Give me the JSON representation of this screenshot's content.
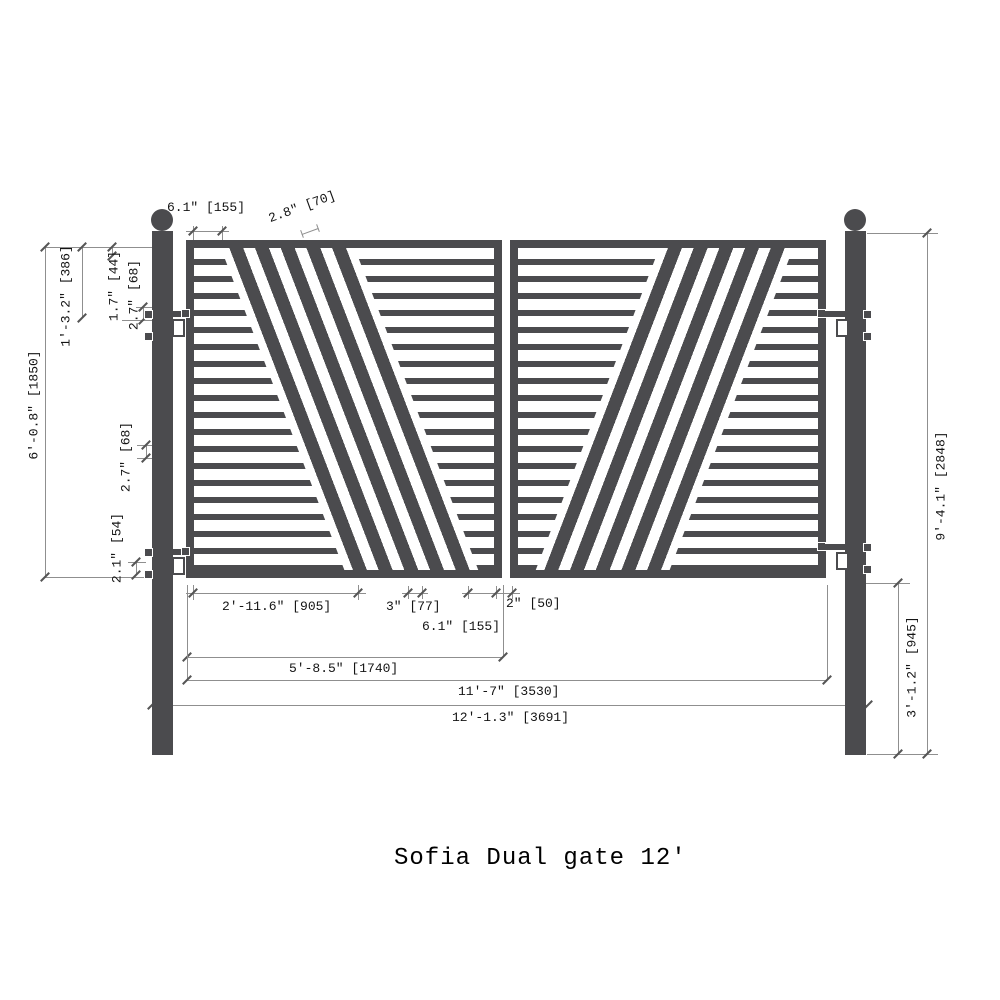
{
  "title": "Sofia Dual gate  12'",
  "drawing": {
    "type": "technical-dimension-drawing",
    "product": "Sofia Dual gate",
    "nominal_size": "12'",
    "panels": 2,
    "diagonal_stripes_per_panel": 5
  },
  "colors": {
    "steel": "#4b4b4e",
    "dimension_line": "#8f8f8f",
    "text": "#141414",
    "background": "#ffffff"
  },
  "dimensions": {
    "top_inset": "6.1\" [155]",
    "diagonal_stripe_width": "2.8\" [70]",
    "top_to_hinge": "1'-3.2\" [386]",
    "bar_thickness": "1.7\" [44]",
    "bar_gap_upper": "2.7\" [68]",
    "leaf_height": "6'-0.8\" [1850]",
    "bar_gap_middle": "2.7\" [68]",
    "bottom_hinge_gap": "2.1\" [54]",
    "overall_height": "9'-4.1\" [2848]",
    "below_gate_height": "3'-1.2\" [945]",
    "bottom_left_span": "2'-11.6\" [905]",
    "stripe_gap": "3\" [77]",
    "bottom_inset": "6.1\" [155]",
    "leaf_gap": "2\" [50]",
    "leaf_width": "5'-8.5\" [1740]",
    "opening_width": "11'-7\" [3530]",
    "overall_width": "12'-1.3\" [3691]"
  }
}
